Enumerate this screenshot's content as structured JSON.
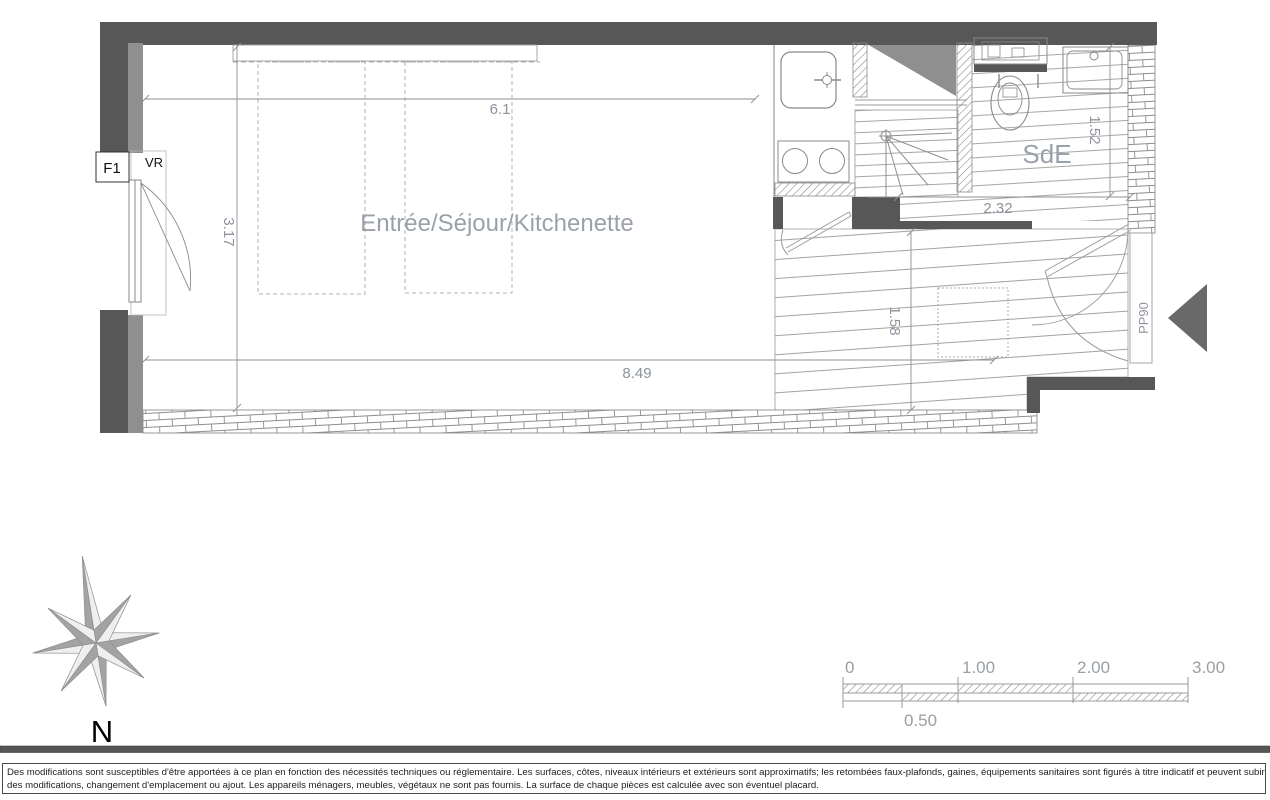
{
  "plan": {
    "main_room": "Entrée/Séjour/Kitchenette",
    "bathroom": "SdE",
    "window_type": "F1",
    "shutter": "VR",
    "entrance_door": "PP90",
    "dim_top": "6.1",
    "dim_left": "3.17",
    "dim_bottom": "8.49",
    "dim_entry": "1.58",
    "dim_sde_v": "1.52",
    "dim_sde_h": "2.32"
  },
  "compass": {
    "north": "N"
  },
  "scale_bar": {
    "t0": "0",
    "t1": "1.00",
    "t2": "2.00",
    "t3": "3.00",
    "half": "0.50"
  },
  "disclaimer": {
    "line1": "Des modifications sont susceptibles d'être apportées à ce plan en fonction des nécessités techniques ou réglementaire. Les surfaces, côtes, niveaux intérieurs et extérieurs sont approximatifs; les retombées faux-plafonds, gaines, équipements sanitaires sont figurés à titre indicatif et peuvent subir",
    "line2": "des modifications, changement d'emplacement ou ajout. Les appareils ménagers, meubles, végétaux ne sont pas fournis. La surface de chaque pièces est calculée avec son éventuel placard."
  },
  "colors": {
    "wall": "#575757",
    "wall_finish": "#8f8f8f",
    "duct_shade": "#8f8f8f",
    "line": "#9b9b9b",
    "dim_text": "#8d939c",
    "room_text": "#9aa1a9",
    "arrow": "#696969",
    "compass_gray": "#a3a3a3"
  }
}
